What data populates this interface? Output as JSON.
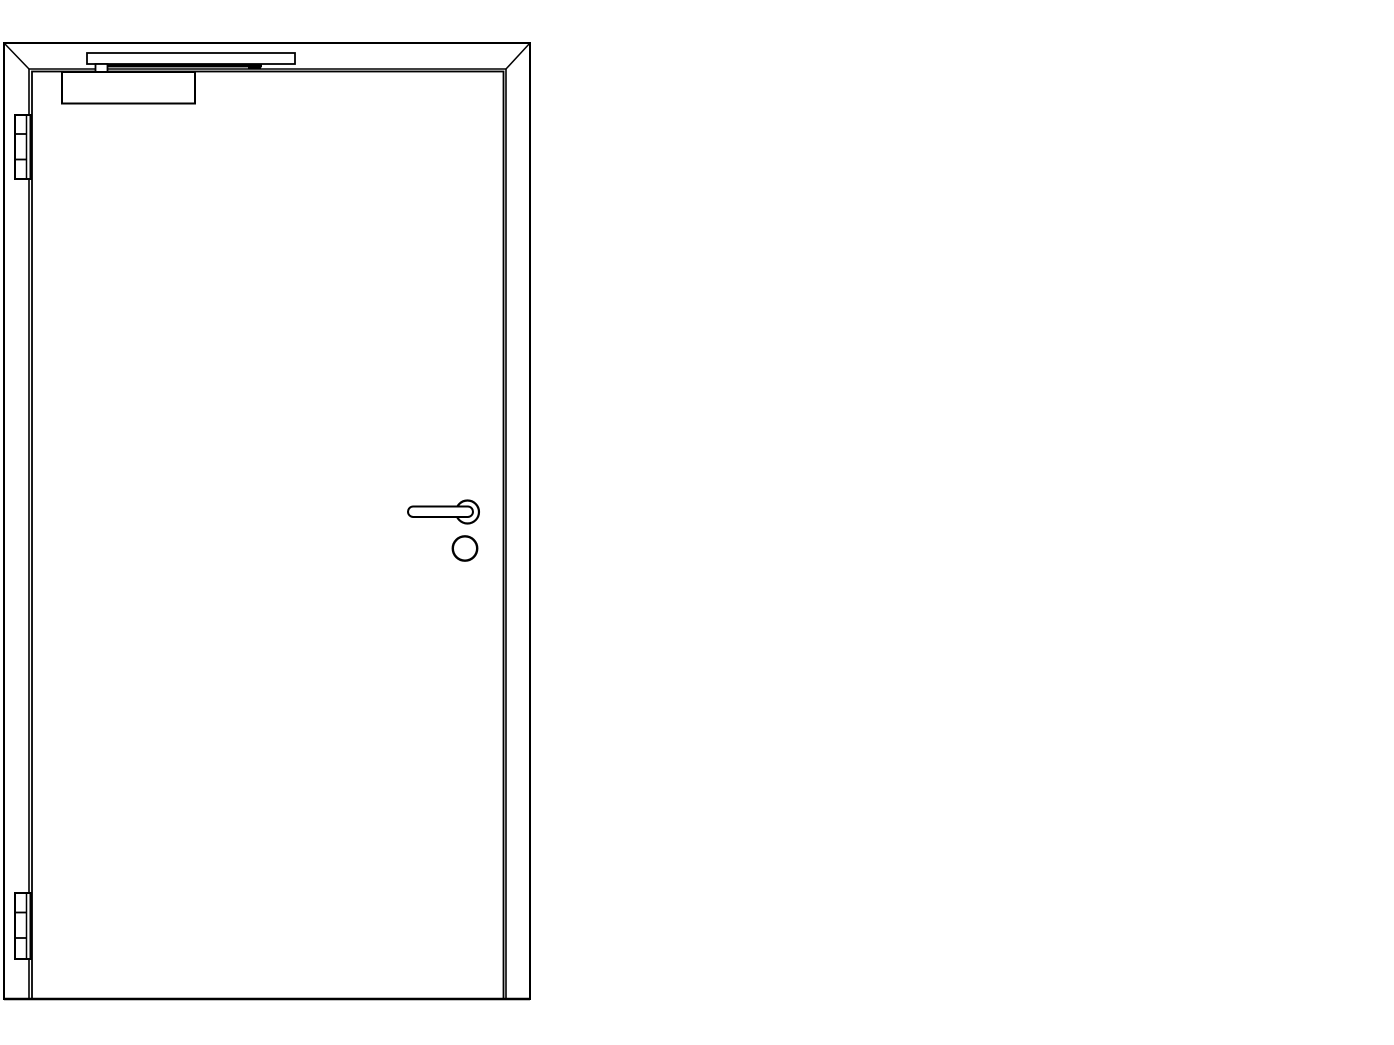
{
  "meta": {
    "description": "Technical CAD-style elevation drawing of a single-leaf hinged door with frame, overhead door closer with slide rail, two butt hinges on the left edge, lever handle on round rose and lock cylinder below"
  },
  "canvas": {
    "width": 1394,
    "height": 1045,
    "background": "#ffffff",
    "stroke_color": "#000000"
  },
  "components": [
    {
      "name": "door-frame-outer",
      "type": "rect",
      "x": 4,
      "y": 43,
      "w": 526,
      "h": 956,
      "sw": 2
    },
    {
      "name": "frame-miter-line-left",
      "type": "line",
      "x1": 4,
      "y1": 43,
      "x2": 29,
      "y2": 69,
      "sw": 1.5
    },
    {
      "name": "frame-miter-line-right",
      "type": "line",
      "x1": 530,
      "y1": 43,
      "x2": 506,
      "y2": 69,
      "sw": 1.5
    },
    {
      "name": "door-frame-rebate",
      "type": "path",
      "d": "M 29 999 L 29 69 L 506 69 L 506 999",
      "sw": 1.6
    },
    {
      "name": "door-leaf",
      "type": "rect",
      "x": 32,
      "y": 71.5,
      "w": 471.5,
      "h": 927.5,
      "sw": 1.8
    },
    {
      "name": "floor-line",
      "type": "line",
      "x1": 4,
      "y1": 999,
      "x2": 530,
      "y2": 999,
      "sw": 2.4
    },
    {
      "name": "closer-slide-rail",
      "type": "rect",
      "x": 87,
      "y": 53,
      "w": 208,
      "h": 11,
      "sw": 1.8,
      "fill": "#ffffff"
    },
    {
      "name": "closer-rail-channel",
      "type": "rect",
      "x": 98,
      "y": 64,
      "w": 164,
      "h": 3.4,
      "fill": "#000000"
    },
    {
      "name": "closer-rail-slider-block",
      "type": "rect",
      "x": 248,
      "y": 64,
      "w": 13,
      "h": 5.5,
      "fill": "#000000"
    },
    {
      "name": "closer-arm-connector",
      "type": "rect",
      "x": 95.5,
      "y": 64,
      "w": 12,
      "h": 8.5,
      "sw": 1.8,
      "fill": "#ffffff"
    },
    {
      "name": "door-closer-body",
      "type": "rect",
      "x": 62,
      "y": 72,
      "w": 133,
      "h": 31.5,
      "sw": 2,
      "fill": "#ffffff"
    },
    {
      "name": "hinge-top",
      "type": "rect",
      "x": 15,
      "y": 115,
      "w": 15.5,
      "h": 64,
      "sw": 2,
      "fill": "#ffffff"
    },
    {
      "name": "hinge-top-barrel-line",
      "type": "line",
      "x1": 26.5,
      "y1": 115,
      "x2": 26.5,
      "y2": 179,
      "sw": 1.5
    },
    {
      "name": "hinge-top-knuckle-upper",
      "type": "line",
      "x1": 15,
      "y1": 134,
      "x2": 26.5,
      "y2": 134,
      "sw": 1.8
    },
    {
      "name": "hinge-top-knuckle-lower",
      "type": "line",
      "x1": 15,
      "y1": 159.5,
      "x2": 26.5,
      "y2": 159.5,
      "sw": 1.8
    },
    {
      "name": "hinge-bottom",
      "type": "rect",
      "x": 15,
      "y": 893,
      "w": 15.5,
      "h": 66,
      "sw": 2,
      "fill": "#ffffff"
    },
    {
      "name": "hinge-bottom-barrel-line",
      "type": "line",
      "x1": 26.5,
      "y1": 893,
      "x2": 26.5,
      "y2": 959,
      "sw": 1.5
    },
    {
      "name": "hinge-bottom-knuckle-upper",
      "type": "line",
      "x1": 15,
      "y1": 912.5,
      "x2": 26.5,
      "y2": 912.5,
      "sw": 1.8
    },
    {
      "name": "hinge-bottom-knuckle-lower",
      "type": "line",
      "x1": 15,
      "y1": 938,
      "x2": 26.5,
      "y2": 938,
      "sw": 1.8
    },
    {
      "name": "handle-rose",
      "type": "circle",
      "cx": 467.5,
      "cy": 512,
      "r": 11.5,
      "sw": 2.2,
      "fill": "#ffffff"
    },
    {
      "name": "lever-handle",
      "type": "rect",
      "x": 408,
      "y": 506.5,
      "w": 65,
      "h": 10.5,
      "rx": 5.2,
      "sw": 2,
      "fill": "#ffffff"
    },
    {
      "name": "lock-cylinder",
      "type": "circle",
      "cx": 465,
      "cy": 548.5,
      "r": 12.2,
      "sw": 2.4,
      "fill": "#ffffff"
    }
  ]
}
